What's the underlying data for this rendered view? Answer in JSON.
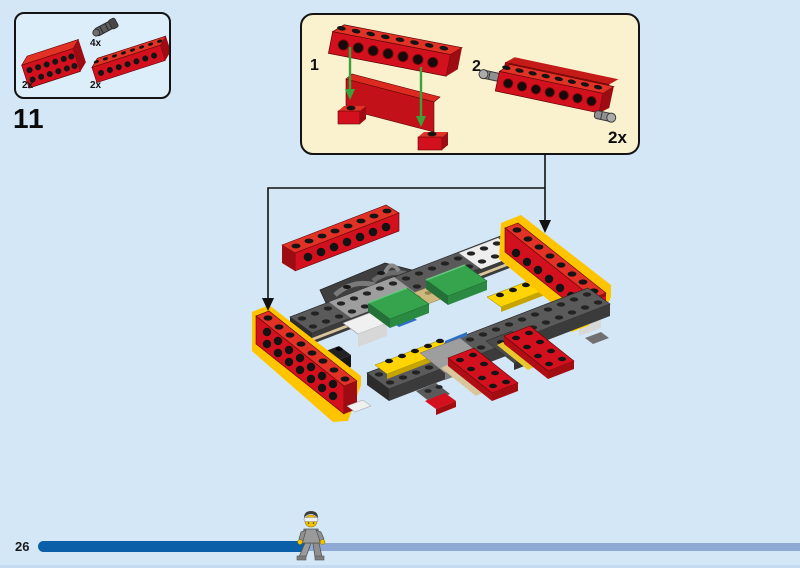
{
  "page": {
    "kind": "lego-building-instructions",
    "background_color": "#d3e7f7",
    "outline_color": "#141414"
  },
  "step": {
    "number": "11"
  },
  "parts_panel": {
    "fill_color": "#ddeefb",
    "parts": [
      {
        "icon": "technic-pin-icon",
        "qty": "4x"
      },
      {
        "icon": "red-bracket-brick-icon",
        "qty": "2x"
      },
      {
        "icon": "red-technic-brick-1x8-icon",
        "qty": "2x"
      }
    ]
  },
  "callout": {
    "fill_color": "#faf1cf",
    "substeps": [
      {
        "label": "1"
      },
      {
        "label": "2"
      }
    ],
    "quantity": "2x",
    "arrow_color": "#3aa23a"
  },
  "model": {
    "new_part_highlight_color": "#ffc400",
    "brick_colors": {
      "red": "#d2101e",
      "dark_gray": "#4a4a4a",
      "light_gray": "#9e9e9e",
      "yellow": "#ffd400",
      "green": "#35a44c",
      "tan": "#d9c79b",
      "blue": "#2e6fc4",
      "white": "#f0f0f0"
    },
    "connector_color": "#111111"
  },
  "footer": {
    "page_number": "26",
    "progress_done_color": "#0b5fa9",
    "progress_rest_color": "#8ea9d4",
    "progress_fraction": 0.36,
    "minifig_icon": "walking-minifigure-icon"
  }
}
